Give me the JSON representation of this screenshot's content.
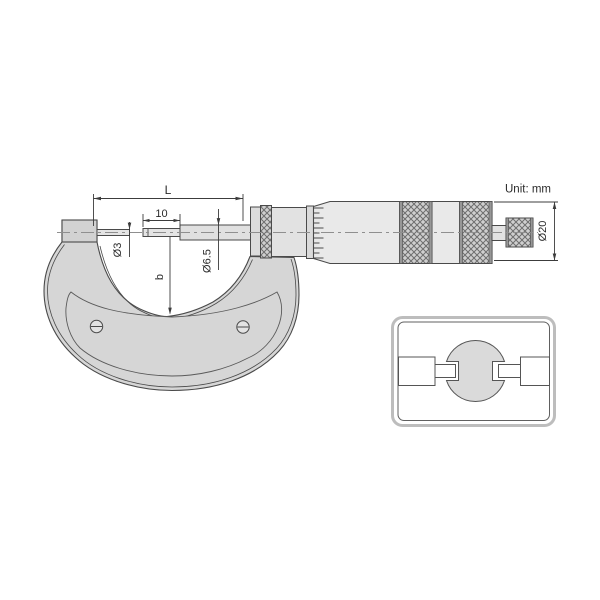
{
  "unit_note": "Unit: mm",
  "dimensions": {
    "overall_length": "L",
    "tip_length": "10",
    "anvil_tip_diameter": "Ø3",
    "spindle_diameter": "Ø6.5",
    "throat_depth": "b",
    "thimble_diameter": "Ø20"
  },
  "colors": {
    "outline": "#4a4a4a",
    "metal_mid": "#d6d6d6",
    "metal_light": "#e8e8e8",
    "centerline": "#8f8f8f",
    "dimension_line": "#3c3c3c",
    "knurl_base": "#cfcfcf",
    "knurl_line": "#6e6e6e",
    "knurl_edge": "#979797",
    "inset_border": "#bdbdbd",
    "background": "#ffffff"
  }
}
